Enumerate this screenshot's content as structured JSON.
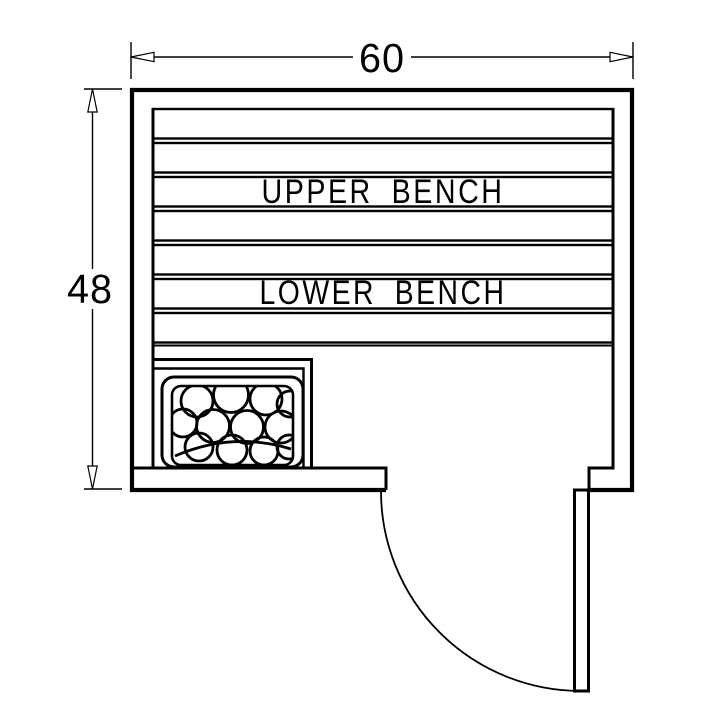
{
  "drawing": {
    "type": "sauna-room-floor-plan",
    "dimensions": {
      "width_label": "60",
      "height_label": "48"
    },
    "labels": {
      "upper_bench": "UPPER BENCH",
      "lower_bench": "LOWER BENCH"
    },
    "features": {
      "bench_slat_count": 7,
      "heater": "rock-heater",
      "door": "quarter-swing-door"
    },
    "colors": {
      "line": "#000000",
      "background": "#ffffff"
    }
  }
}
